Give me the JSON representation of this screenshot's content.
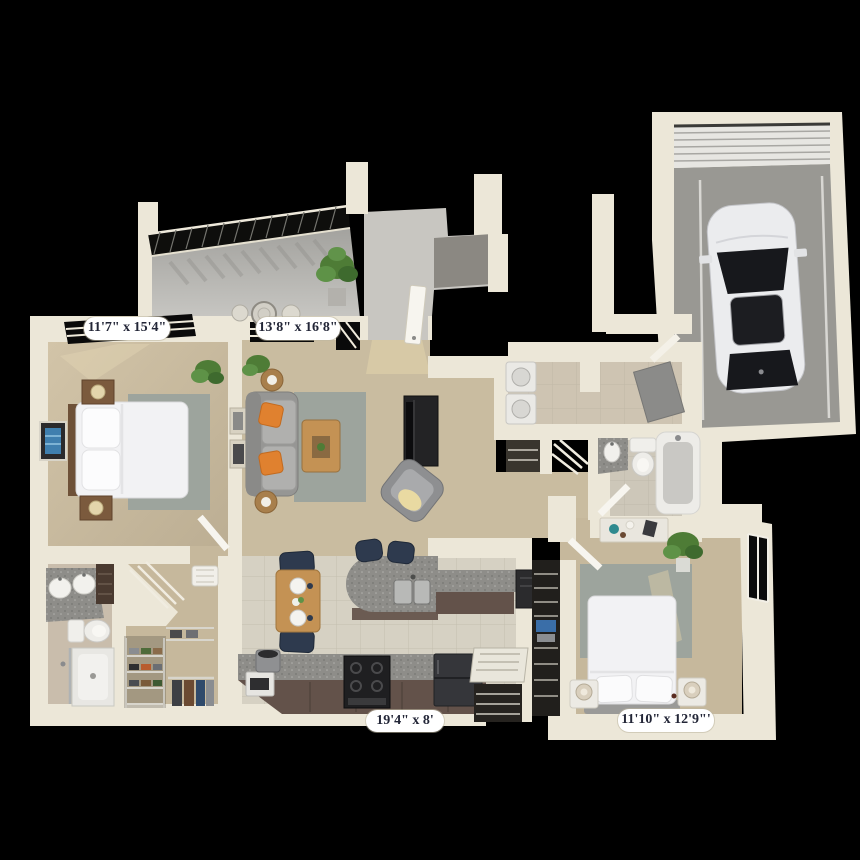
{
  "labels": {
    "master_bedroom": "11'7\" x 15'4\"",
    "living_room": "13'8\" x 16'8\"",
    "kitchen": "19'4\" x 8'",
    "second_bedroom": "11'10\" x 12'9\"'"
  },
  "colors": {
    "bg": "#000000",
    "wall": "#ece7d8",
    "wall-shade": "#d9d2c0",
    "carpet": "#c6b89c",
    "carpet2": "#c9bca0",
    "tile": "#d6d1c3",
    "tile-laundry": "#cec4b2",
    "tile-bath": "#cdc7b9",
    "concrete": "#b5b4b0",
    "garage-floor": "#999893",
    "rug": "#9da49d",
    "granite": "#8e8d89",
    "cabinet": "#63524a",
    "wood": "#c49254",
    "navy": "#2e3a4e",
    "orange": "#e0812f",
    "white-furn": "#f2f2f4",
    "green": "#4e7c36",
    "car-body": "#ebecee",
    "glass": "#17181c",
    "label-bg": "#ffffff",
    "label-text": "#232637"
  }
}
